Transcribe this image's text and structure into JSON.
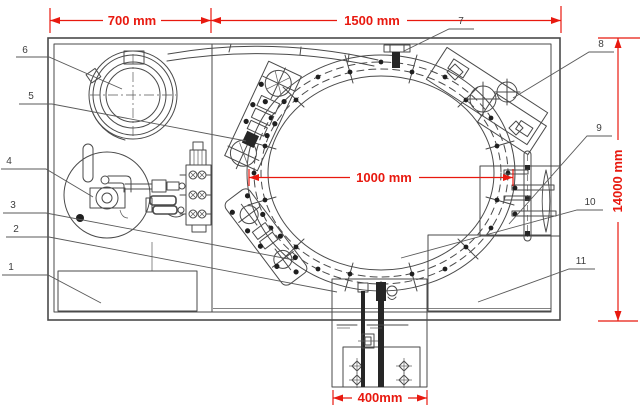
{
  "drawing": {
    "view": "machine layout top view",
    "dimensions": {
      "section_left": "700 mm",
      "section_right": "1500 mm",
      "turntable_diameter": "1000 mm",
      "total_length": "14000 mm",
      "base_width": "400mm"
    },
    "callouts": [
      "1",
      "2",
      "3",
      "4",
      "5",
      "6",
      "7",
      "8",
      "9",
      "10",
      "11"
    ],
    "colors": {
      "dimension": "#e8190f",
      "line": "#4a4a4a",
      "background": "#ffffff"
    }
  }
}
